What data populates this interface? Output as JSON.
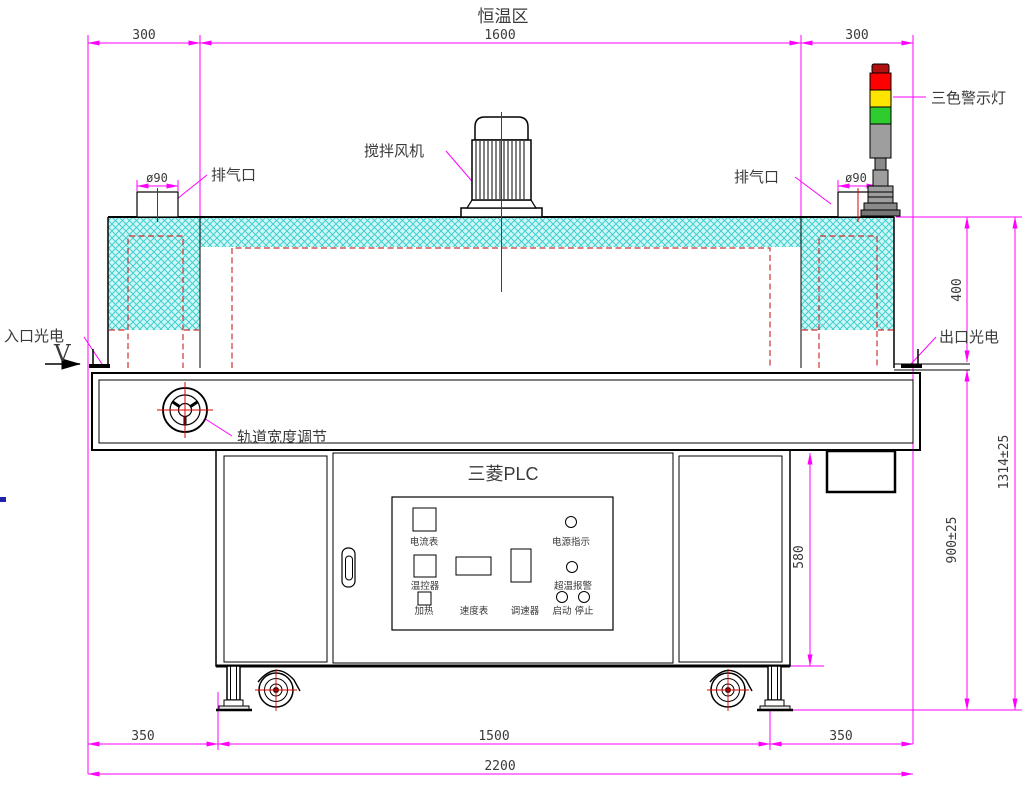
{
  "title": "恒温区",
  "dimensions": {
    "top_left": "300",
    "top_center": "1600",
    "top_right": "300",
    "vent_left_dia": "ø90",
    "vent_right_dia": "ø90",
    "oven_height": "400",
    "total_height": "1314±25",
    "table_height": "900±25",
    "cabinet_height": "580",
    "bottom_left": "350",
    "bottom_center": "1500",
    "bottom_right": "350",
    "total_length": "2200"
  },
  "labels": {
    "exhaust_left": "排气口",
    "exhaust_right": "排气口",
    "stir_fan": "搅拌风机",
    "warning_light": "三色警示灯",
    "inlet_sensor": "入口光电",
    "outlet_sensor": "出口光电",
    "direction": "V",
    "track_width_adjust": "轨道宽度调节"
  },
  "control_panel": {
    "title": "三菱PLC",
    "ammeter": "电流表",
    "power_indicator": "电源指示",
    "temp_controller": "温控器",
    "speed_meter": "速度表",
    "speed_regulator": "调速器",
    "overtemp_alarm": "超温报警",
    "heater": "加热",
    "start": "启动",
    "stop": "停止"
  },
  "colors": {
    "dimension": "#ff00ff",
    "centerline": "#dd0000",
    "hidden_line": "#cc3333",
    "insulation_fill": "#d2f7f7",
    "insulation_hatch": "#3fd0d0",
    "light_cap": "#b01010",
    "light_red": "#ff0000",
    "light_yellow": "#ffe400",
    "light_green": "#2ecc2e",
    "light_gray": "#9e9e9e"
  }
}
